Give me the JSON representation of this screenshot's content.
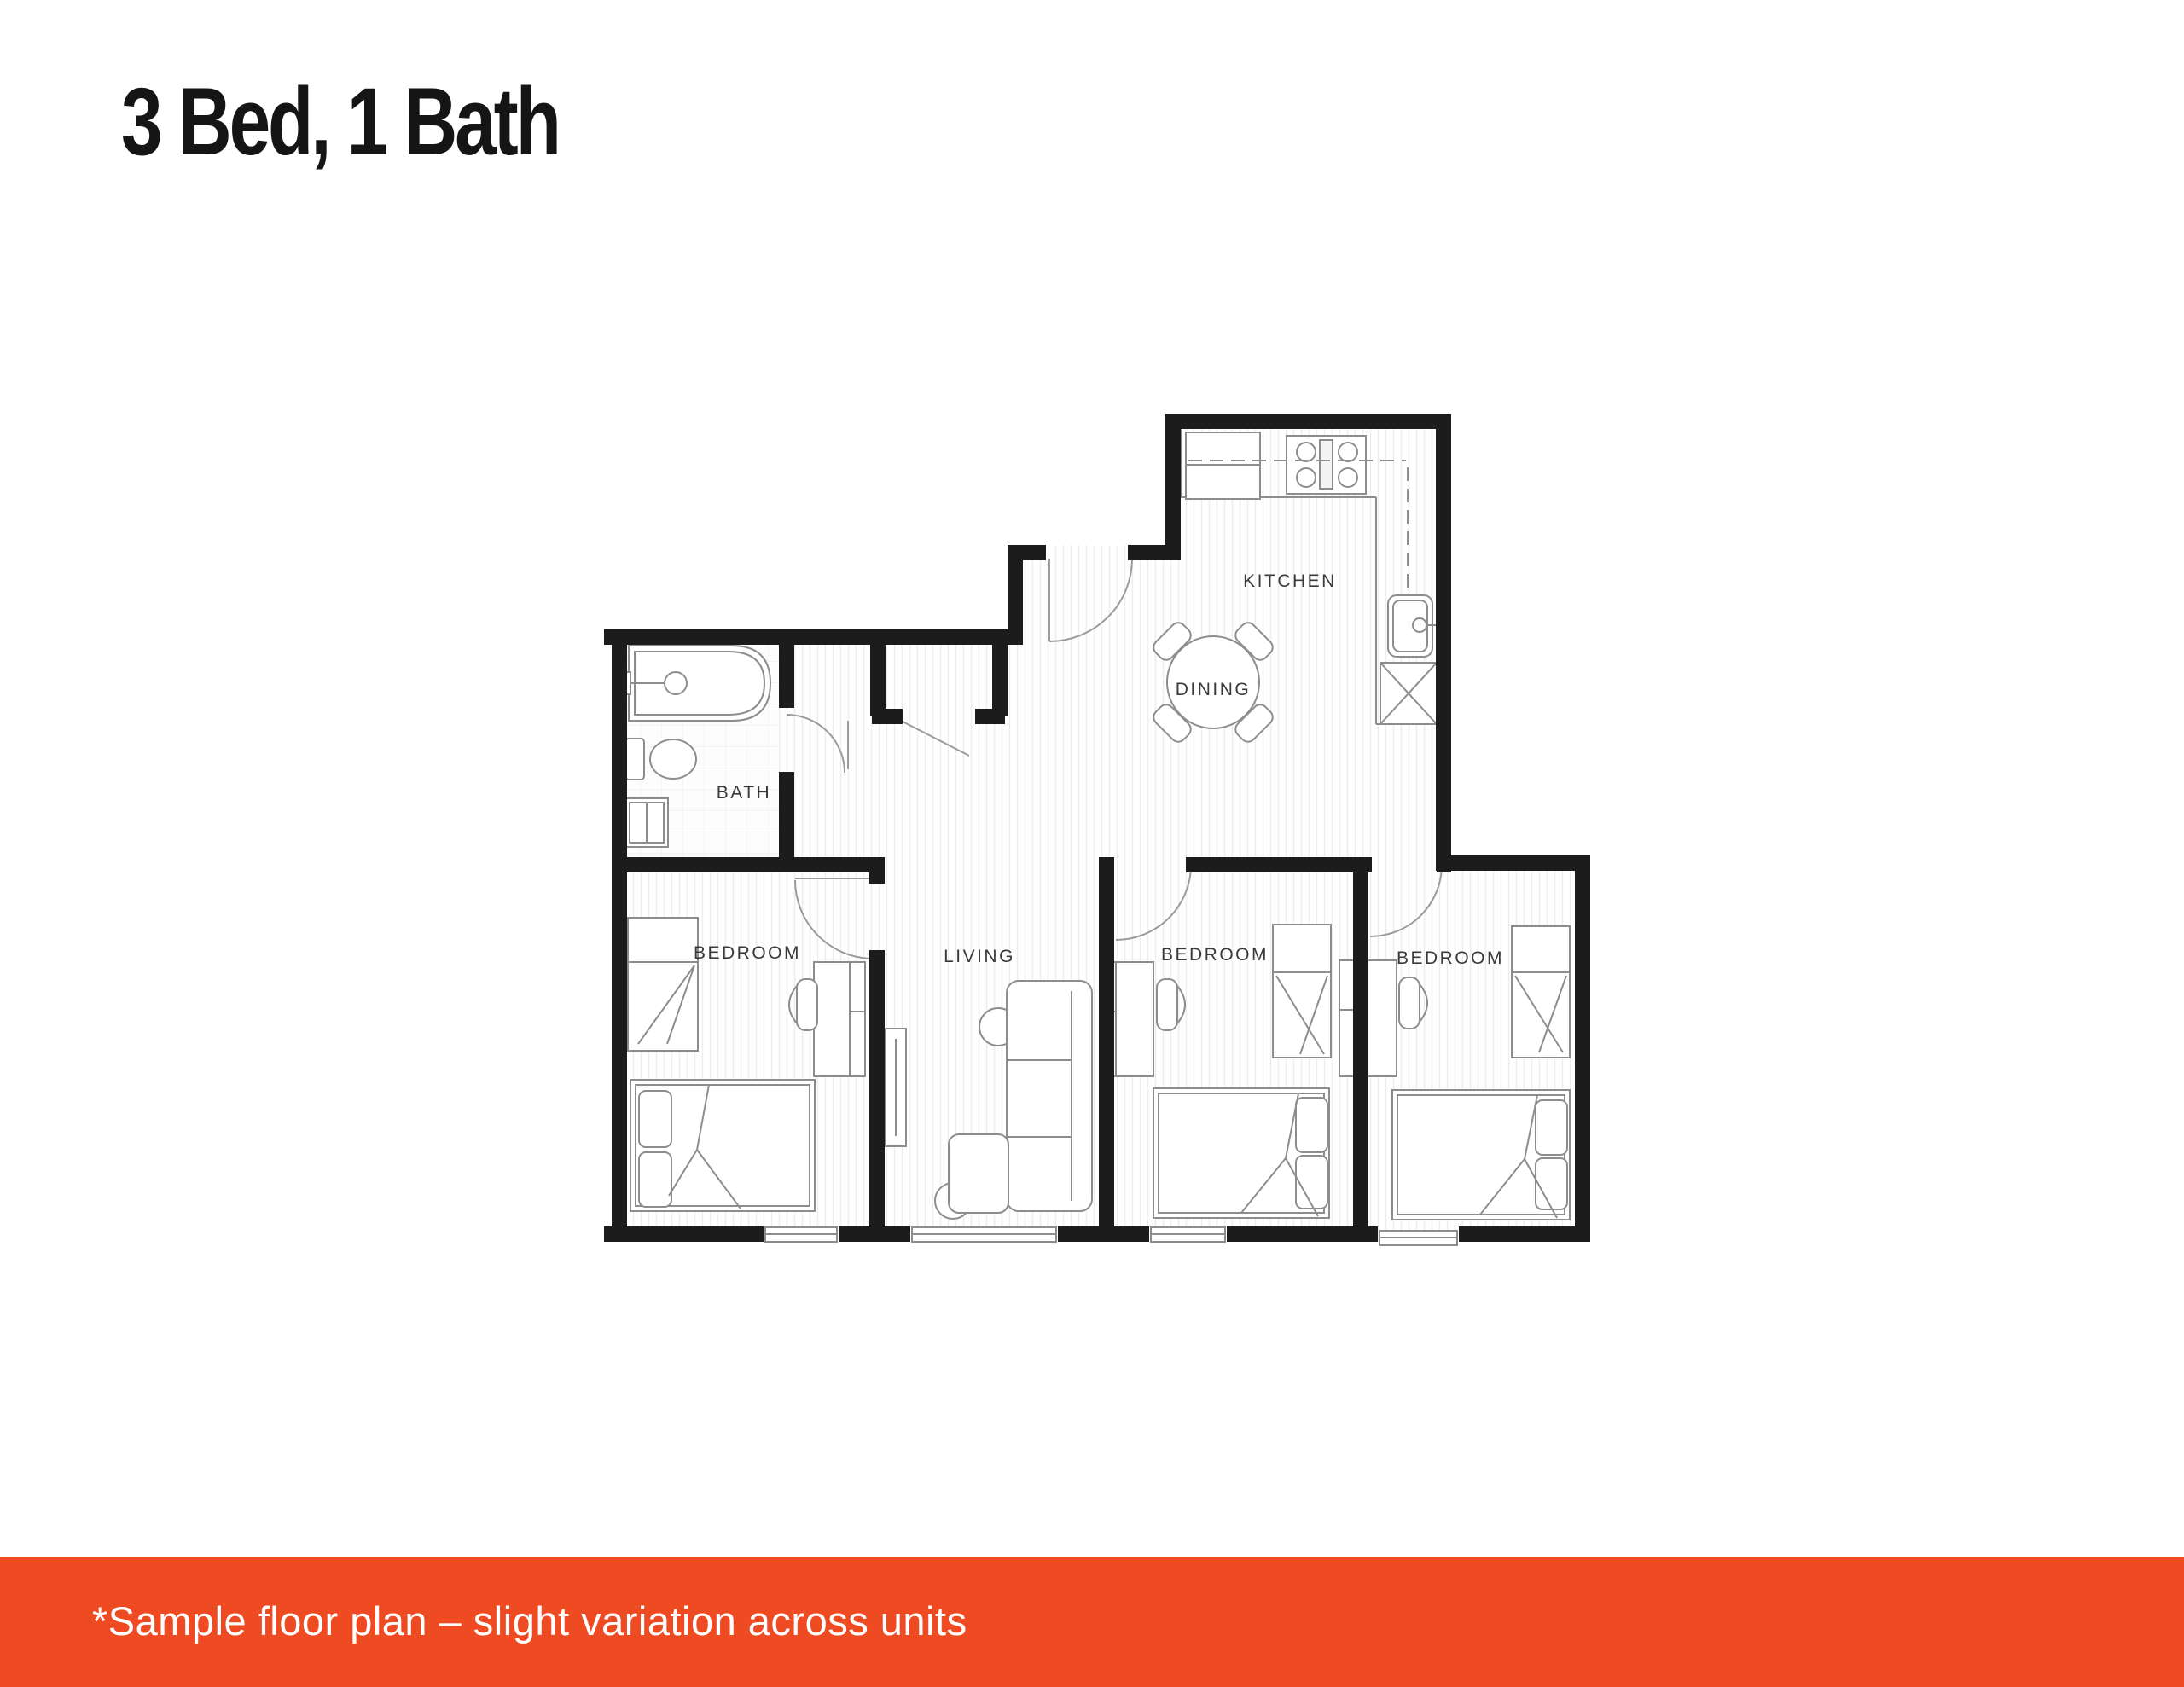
{
  "title": "3 Bed, 1 Bath",
  "plan": {
    "rooms": {
      "kitchen": "KITCHEN",
      "dining": "DINING",
      "bath": "BATH",
      "bedroom_left": "BEDROOM",
      "living": "LIVING",
      "bedroom_middle": "BEDROOM",
      "bedroom_right": "BEDROOM"
    }
  },
  "footer": {
    "note": "*Sample floor plan – slight variation across units"
  },
  "colors": {
    "accent_orange": "#EF4B23",
    "wall_black": "#1C1C1C",
    "furniture_gray": "#8D8D8D",
    "footer_text": "#FFFFFF",
    "title_color": "#151515"
  }
}
